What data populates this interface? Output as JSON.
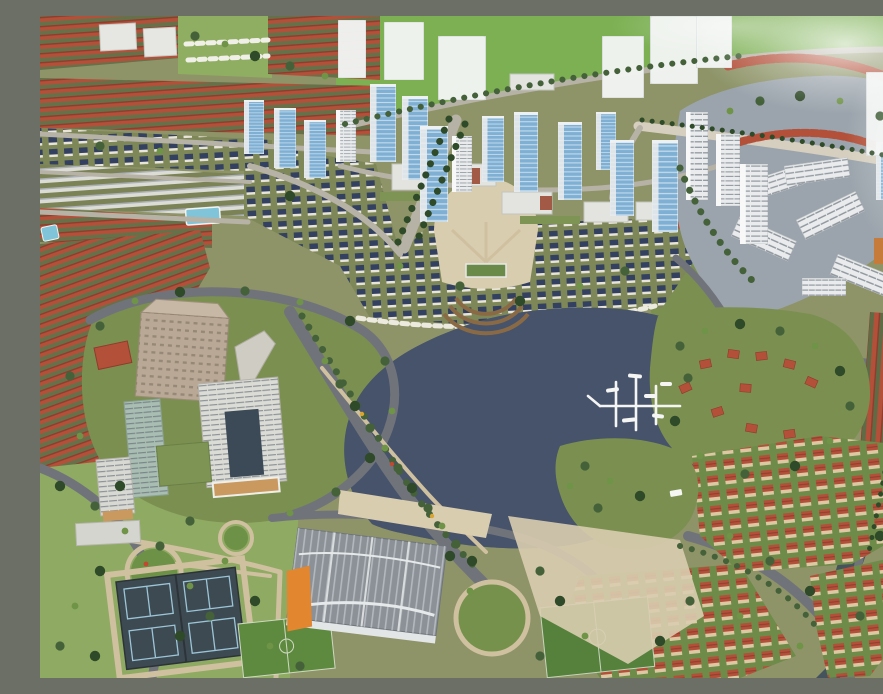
{
  "image": {
    "type": "photograph",
    "subject": "Oblique aerial photo of an architectural scale model of a lakeside planned urban area with high-rise towers, villa districts, parks and sports facilities"
  },
  "palette": {
    "ground": "#8e9468",
    "field_green": "#7cb053",
    "lawn": "#7b9050",
    "park_green": "#8fae62",
    "grass_dark": "#5d7d42",
    "lake_dark": "#46536b",
    "lake_gray": "#9ba4ac",
    "canal": "#45545c",
    "road_dark": "#70747a",
    "road_light": "#b7b2a6",
    "path_tan": "#cfc0a0",
    "plaza_tan": "#d9cdb0",
    "red_roof": "#b3503a",
    "red_roof_dark": "#8f3c2c",
    "navy_roof": "#334060",
    "tower_blue": "#7fb0d4",
    "tower_white": "#e9ebec",
    "frosted": "#f3f5f4",
    "office_tan": "#b9a895",
    "office_white": "#dcdcd6",
    "glass_dark": "#3c4a58",
    "orange": "#e2862f",
    "club_gray": "#8b9197",
    "court": "#3e4a52",
    "court_line": "#9cc5d8",
    "pool_blue": "#7fc4d8",
    "white": "#f5f6f3",
    "tree_dark": "#2f4a28",
    "tree_mid": "#44613a",
    "tree_light": "#6f9347",
    "flower_yellow": "#d9a42f",
    "flower_red": "#c0492f",
    "billboard": "#c9995f",
    "pitch_green": "#55813c"
  },
  "scene": {
    "regions": [
      {
        "name": "green-field",
        "label": "large bright lawn across the top of the model",
        "bbox": [
          296,
          0,
          587,
          116
        ]
      },
      {
        "name": "frosted-future-towers",
        "label": "translucent white acrylic towers along the field edge (future phase)",
        "count": 7,
        "bbox": [
          290,
          0,
          420,
          100
        ]
      },
      {
        "name": "highrise-cluster",
        "label": "blue glass high-rise towers with white frames",
        "count": 19,
        "bbox": [
          200,
          40,
          520,
          190
        ]
      },
      {
        "name": "central-boulevard",
        "label": "tree-lined boulevard leading from the towers to the lakeside plaza",
        "bbox": [
          355,
          100,
          70,
          135
        ]
      },
      {
        "name": "navy-villa-district",
        "label": "rows of small white villas with dark navy roofs",
        "bbox": [
          0,
          112,
          660,
          196
        ]
      },
      {
        "name": "amphitheater-plaza",
        "label": "semicircular terraced lakeside plaza with a green-roofed stage",
        "bbox": [
          385,
          205,
          125,
          100
        ]
      },
      {
        "name": "red-townhouse-rows-west",
        "label": "dense diagonal rows of terracotta-roofed townhouses on the left",
        "bbox": [
          0,
          0,
          340,
          452
        ]
      },
      {
        "name": "white-lowrise-rows",
        "label": "rows of long white low-rise blocks",
        "bbox": [
          0,
          148,
          204,
          52
        ]
      },
      {
        "name": "cottage-park",
        "label": "lawn with rows of small white cottages",
        "bbox": [
          138,
          0,
          200,
          70
        ]
      },
      {
        "name": "swimming-pool",
        "label": "light blue pool",
        "bbox": [
          146,
          190,
          36,
          18
        ]
      },
      {
        "name": "office-campus",
        "label": "tan and white office mid-rises with a dark glass atrium and green roofs",
        "bbox": [
          50,
          262,
          320,
          250
        ]
      },
      {
        "name": "main-lake",
        "label": "dark blue lake with sparkling water surface",
        "bbox": [
          295,
          288,
          415,
          250
        ]
      },
      {
        "name": "boat-jetty",
        "label": "white floating jetty grid with small boats",
        "bbox": [
          548,
          358,
          100,
          60
        ]
      },
      {
        "name": "north-lake",
        "label": "silver-gray sparkling lake in the upper right",
        "bbox": [
          600,
          50,
          283,
          260
        ]
      },
      {
        "name": "lake-bridge",
        "label": "light causeway crossing the north lake",
        "bbox": [
          598,
          100,
          285,
          56
        ]
      },
      {
        "name": "lakeside-apartments-east",
        "label": "white apartment slabs zigzagging along the east shore",
        "bbox": [
          690,
          140,
          193,
          170
        ]
      },
      {
        "name": "red-roof-arcs-northeast",
        "label": "curved rows of red-roofed townhouses around the north lake",
        "bbox": [
          598,
          30,
          285,
          210
        ]
      },
      {
        "name": "peninsula-villas",
        "label": "green peninsula with a looping path and scattered red-roof villas",
        "bbox": [
          605,
          288,
          230,
          185
        ]
      },
      {
        "name": "red-townhouse-rows-east",
        "label": "long red-roof rows along the right edge",
        "bbox": [
          795,
          280,
          88,
          260
        ]
      },
      {
        "name": "villa-clusters-southeast",
        "label": "clusters of red-roofed villas along curving streets",
        "bbox": [
          520,
          410,
          363,
          252
        ]
      },
      {
        "name": "canal-southeast",
        "label": "dark canal curving through the lower right",
        "bbox": [
          776,
          420,
          107,
          242
        ]
      },
      {
        "name": "clubhouse",
        "label": "gray ribbed-roof clubhouse with an orange corner",
        "bbox": [
          250,
          505,
          165,
          140
        ]
      },
      {
        "name": "tennis-courts",
        "label": "four dark courts with light blue markings",
        "count": 4,
        "bbox": [
          64,
          556,
          150,
          106
        ]
      },
      {
        "name": "sports-pitches",
        "label": "two green pitches",
        "count": 2,
        "bbox": [
          196,
          592,
          415,
          70
        ]
      },
      {
        "name": "south-park",
        "label": "park with circular flower gardens and winding paths",
        "bbox": [
          0,
          440,
          260,
          222
        ]
      },
      {
        "name": "glare",
        "label": "white light reflection across the top right corner"
      }
    ]
  }
}
